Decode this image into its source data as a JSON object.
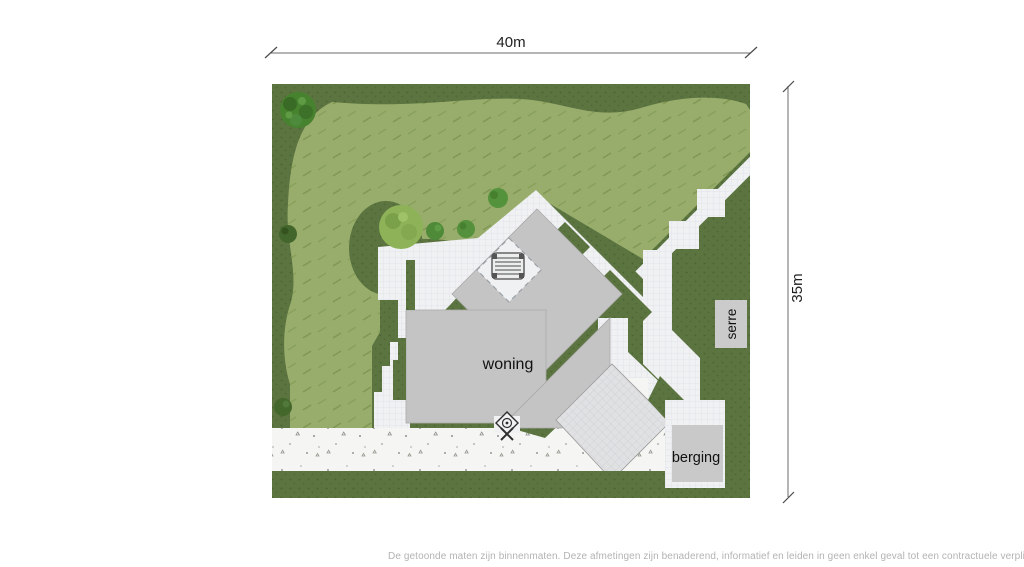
{
  "figure": {
    "type": "site-plan",
    "dimensions": {
      "width_label": "40m",
      "height_label": "35m"
    },
    "labels": {
      "house": "woning",
      "conservatory": "serre",
      "shed": "berging"
    },
    "colors": {
      "garden_dark": "#5b7440",
      "lawn": "#98ad6c",
      "path_white": "#f0f1f3",
      "house_gray": "#c4c4c4",
      "shed_gray": "#c9c9c9",
      "label_box_gray": "#cbcbcb",
      "terrace_speckled": "#f5f5f3",
      "dimension_line": "#6b6b6b",
      "dimension_text": "#1f1f1f",
      "disclaimer_text": "#b3b3b3"
    },
    "footer": {
      "disclaimer": "De getoonde maten zijn binnenmaten. Deze afmetingen zijn benaderend, informatief en leiden in geen enkel geval tot een contractuele verplichting."
    }
  }
}
